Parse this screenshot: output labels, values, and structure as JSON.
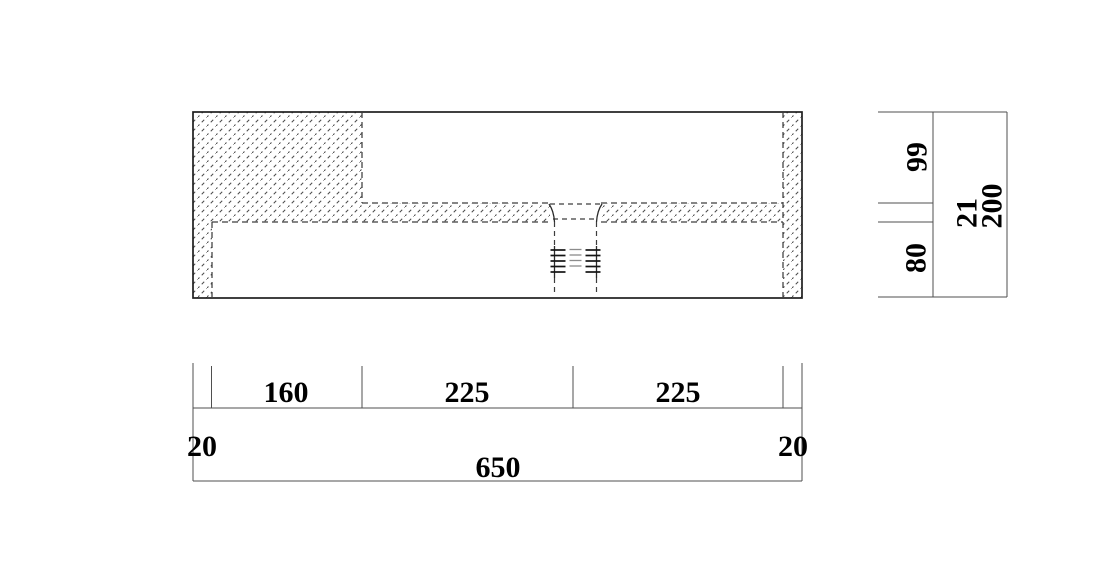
{
  "dimensions": {
    "bottom": {
      "segments": [
        "160",
        "225",
        "225"
      ],
      "left_wall": "20",
      "right_wall": "20",
      "overall": "650"
    },
    "side": {
      "upper": "99",
      "slab": "21",
      "lower": "80",
      "overall": "200"
    }
  },
  "style": {
    "background": "#ffffff",
    "outline_color": "#1f1f1f",
    "hidden_line_color": "#3d3d3d",
    "hatch_color": "#4a4a4a",
    "dimension_line_color": "#4f4f4f",
    "text_color": "#000000"
  }
}
